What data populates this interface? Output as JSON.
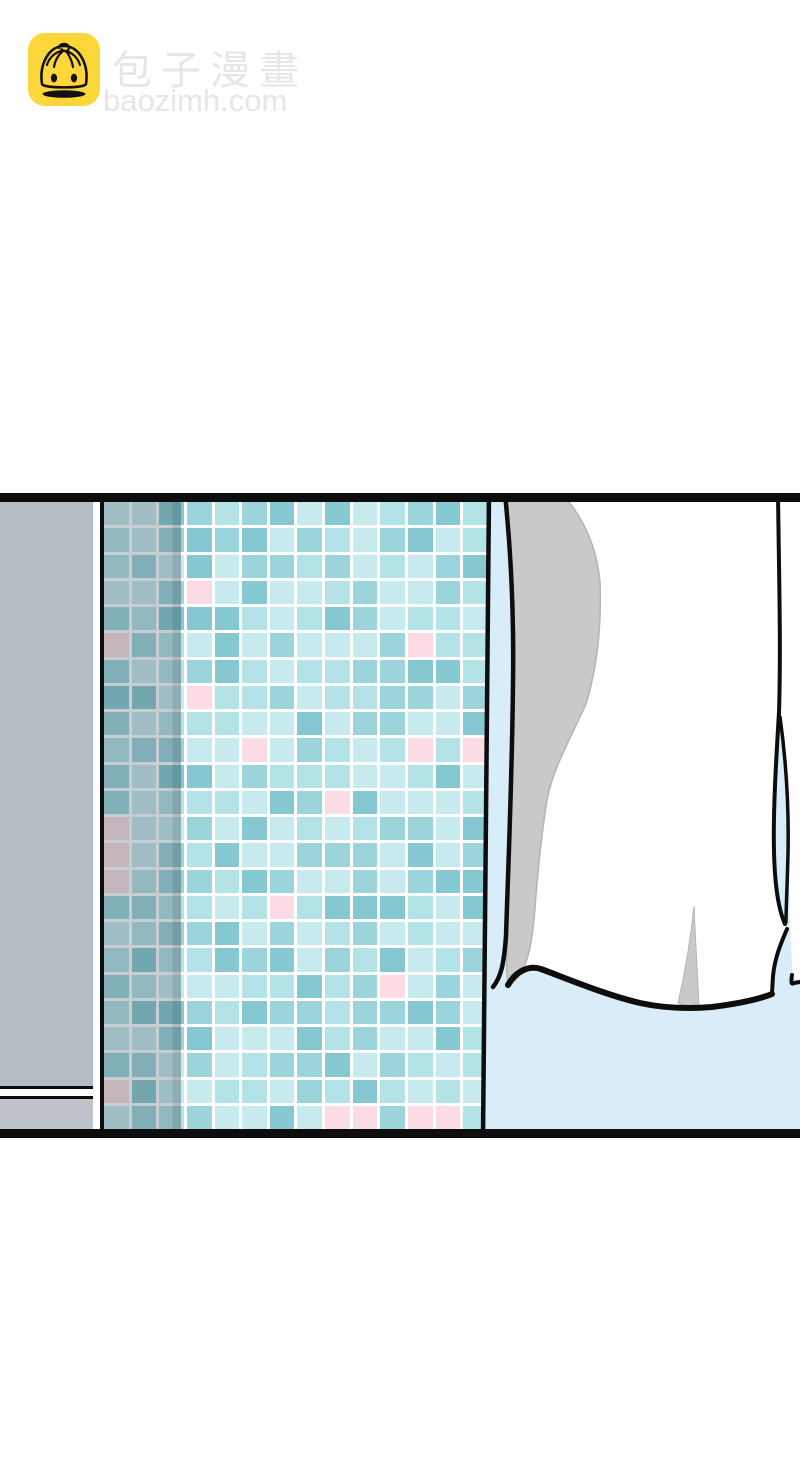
{
  "site": {
    "name": "包子漫畫",
    "domain": "baozimh.com"
  },
  "colors": {
    "black": "#0d0d0d",
    "logo_yellow": "#fdd63a",
    "text_gray": "#e6e6e6",
    "wall_gray": "#b6bcc4",
    "wall_gray_light": "#bec3c9",
    "grout_white": "#ffffff",
    "wall_blue": "#d8edf8",
    "curtain_white": "#ffffff",
    "curtain_shadow_gray": "#c9c9c9",
    "curtain_shadow_edge": "#b4b4b4"
  },
  "panel": {
    "tile_wall": {
      "cols": 14,
      "rows": 24,
      "seed": 123457,
      "palette": [
        "#c6eaee",
        "#b3e2e7",
        "#9bd4db",
        "#85c8d1"
      ],
      "pink": "#fbdce4",
      "pink_tiles": [
        [
          3,
          3
        ],
        [
          11,
          5
        ],
        [
          0,
          5
        ],
        [
          3,
          7
        ],
        [
          5,
          9
        ],
        [
          11,
          9
        ],
        [
          13,
          9
        ],
        [
          8,
          11
        ],
        [
          0,
          12
        ],
        [
          0,
          13
        ],
        [
          0,
          14
        ],
        [
          6,
          15
        ],
        [
          10,
          18
        ],
        [
          0,
          22
        ],
        [
          8,
          23
        ],
        [
          9,
          23
        ],
        [
          11,
          23
        ],
        [
          12,
          23
        ]
      ]
    }
  }
}
